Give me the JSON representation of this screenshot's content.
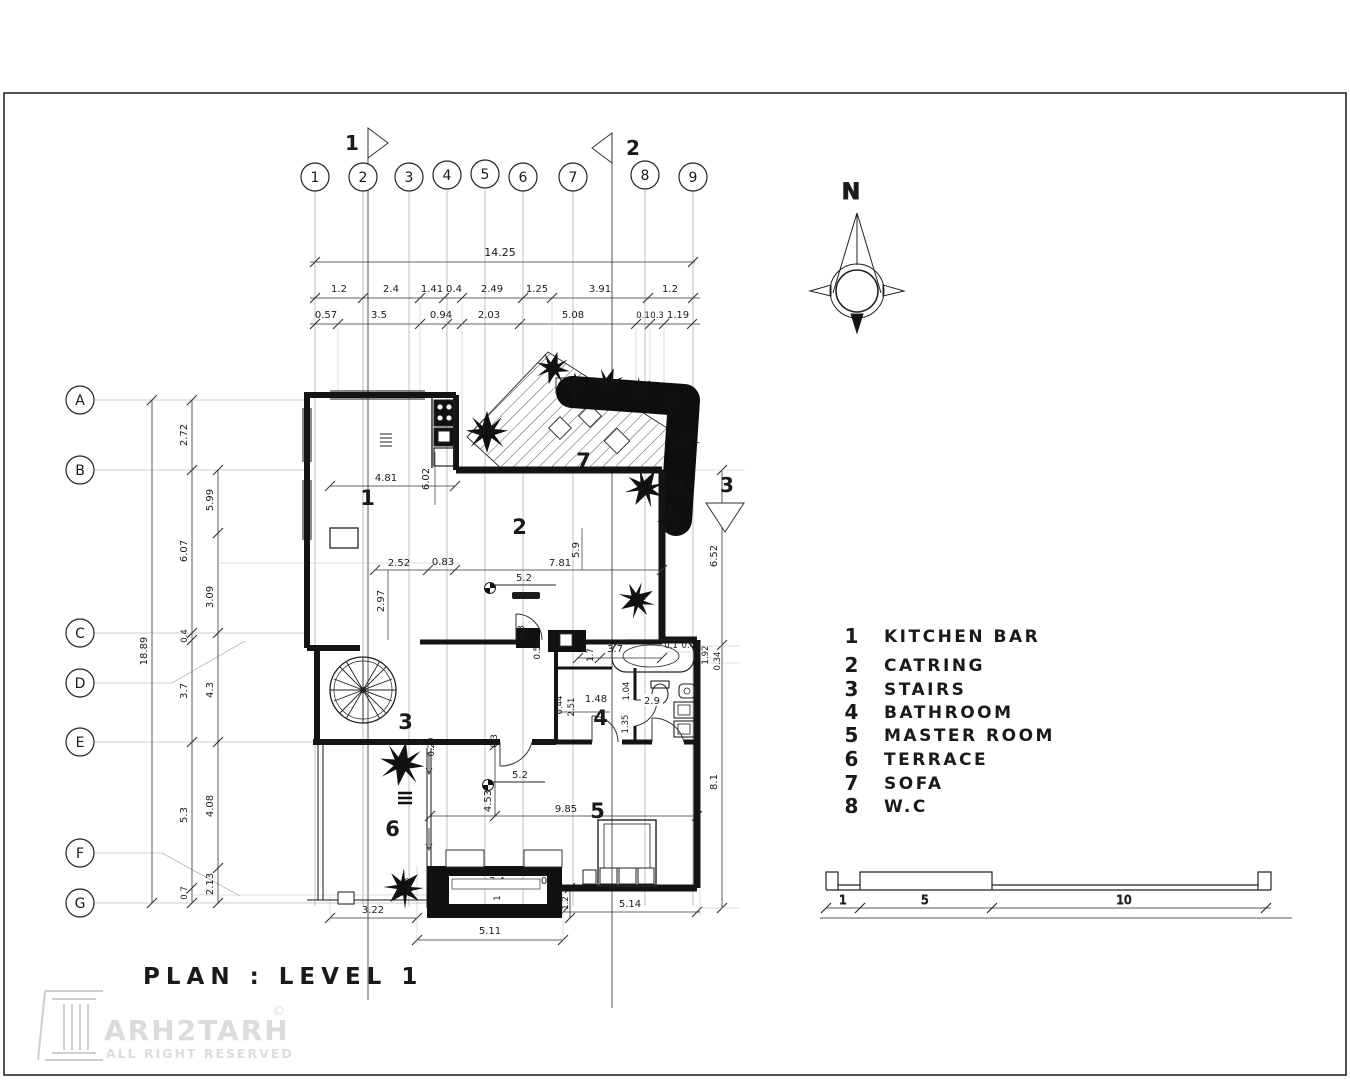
{
  "title": "PLAN : LEVEL 1",
  "watermark": {
    "brand": "ARH2TARH",
    "copyright": "©",
    "tagline": "ALL RIGHT RESERVED"
  },
  "north_label": "N",
  "grid": {
    "top": [
      "1",
      "2",
      "3",
      "4",
      "5",
      "6",
      "7",
      "8",
      "9"
    ],
    "left": [
      "A",
      "B",
      "C",
      "D",
      "E",
      "F",
      "G"
    ]
  },
  "sections": {
    "s1": "1",
    "s2": "2",
    "s3": "3"
  },
  "legend": {
    "items": [
      {
        "num": "1",
        "label": "KITCHEN BAR"
      },
      {
        "num": "2",
        "label": "CATRING"
      },
      {
        "num": "3",
        "label": "STAIRS"
      },
      {
        "num": "4",
        "label": "BATHROOM"
      },
      {
        "num": "5",
        "label": "MASTER ROOM"
      },
      {
        "num": "6",
        "label": "TERRACE"
      },
      {
        "num": "7",
        "label": "SOFA"
      },
      {
        "num": "8",
        "label": "W.C"
      }
    ]
  },
  "rooms": {
    "r1": "1",
    "r2": "2",
    "r3": "3",
    "r4": "4",
    "r5": "5",
    "r6": "6",
    "r7": "7"
  },
  "dims": {
    "top": {
      "overall": "14.25",
      "row2": [
        "1.2",
        "2.4",
        "1.41",
        "0.4",
        "2.49",
        "1.25",
        "3.91",
        "1.2"
      ],
      "row3": [
        "0.57",
        "3.5",
        "0.94",
        "2.03",
        "5.08",
        "0.1",
        "0.3",
        "1.19"
      ]
    },
    "left": {
      "overall": "18.89",
      "chain_a": [
        "2.72",
        "6.07",
        "0.4",
        "3.7",
        "5.3",
        "0.7"
      ],
      "chain_b": [
        "5.99",
        "3.09",
        "4.3",
        "4.08",
        "2.13"
      ]
    },
    "right": {
      "chain": [
        "6.52",
        "1.92",
        "0.34",
        "8.1"
      ],
      "small": [
        "0.1",
        "0.49"
      ]
    },
    "bottom": [
      "3.22",
      "5.11",
      "3.4",
      "0.61",
      "1",
      "1.2",
      "5.14",
      "2.93"
    ],
    "interior": [
      "4.81",
      "6.02",
      "2.52",
      "0.83",
      "2.97",
      "7.81",
      "5.9",
      "0.3",
      "0.53",
      "1.7",
      "3.7",
      "0.44",
      "2.51",
      "1.48",
      "1.04",
      "2.9",
      "1.35",
      "0.29",
      "0.3",
      "4.53",
      "9.85"
    ],
    "levels": [
      "5.2",
      "5.2"
    ]
  },
  "scalebar": {
    "labels": [
      "1",
      "5",
      "10"
    ]
  }
}
